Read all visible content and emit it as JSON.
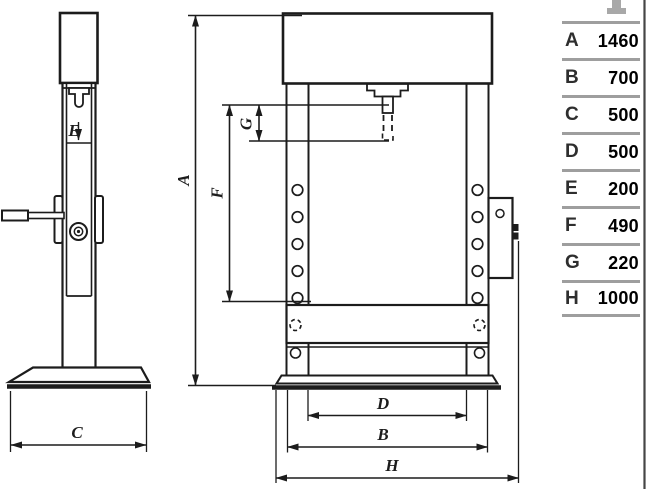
{
  "drawing": {
    "description": "Two-view technical drawing of a hydraulic workshop press",
    "dims": {
      "A": "A",
      "B": "B",
      "C": "C",
      "D": "D",
      "E": "E",
      "F": "F",
      "G": "G",
      "H": "H"
    }
  },
  "table": {
    "rows": [
      {
        "label": "A",
        "value": "1460"
      },
      {
        "label": "B",
        "value": "700"
      },
      {
        "label": "C",
        "value": "500"
      },
      {
        "label": "D",
        "value": "500"
      },
      {
        "label": "E",
        "value": "200"
      },
      {
        "label": "F",
        "value": "490"
      },
      {
        "label": "G",
        "value": "220"
      },
      {
        "label": "H",
        "value": "1000"
      }
    ]
  },
  "colors": {
    "line": "#1c1c1c",
    "table_separator": "#9e9e9e",
    "table_text": "#000000",
    "right_border": "#454545",
    "background": "#ffffff"
  }
}
